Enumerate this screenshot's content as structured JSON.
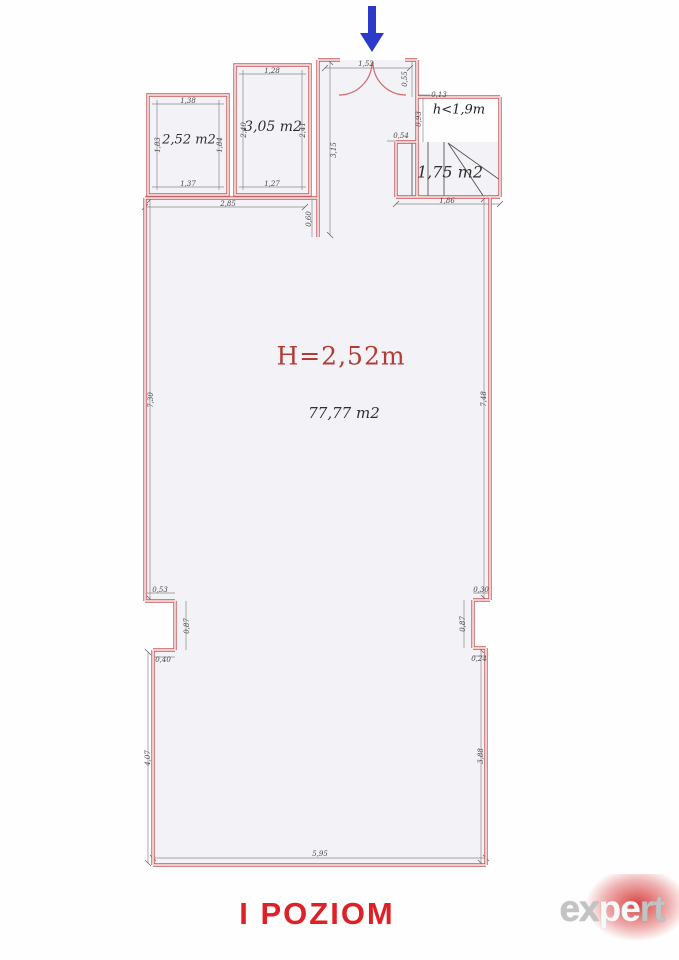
{
  "title": "I POZIOM",
  "plan": {
    "entrance": {
      "dim_door": "1,52",
      "dim_right": "0,55",
      "dim_corridor": "3,15",
      "dim_stub": "0,60"
    },
    "low_headroom": {
      "label": "h<1,9m",
      "dim_top": "0,13",
      "dim_left": "0,93",
      "dim_offset": "0,54"
    },
    "stairs": {
      "area": "1,75 m2",
      "dim_bottom": "1,86"
    },
    "room_252": {
      "area": "2,52 m2",
      "dim_top": "1,38",
      "dim_bottom": "1,37",
      "dim_left": "1,83",
      "dim_right": "1,84"
    },
    "room_305": {
      "area": "3,05 m2",
      "dim_top": "1,28",
      "dim_bottom": "1,27",
      "dim_left": "2,40",
      "dim_right": "2,41"
    },
    "main_room": {
      "height_label": "H=2,52m",
      "area": "77,77 m2",
      "dim_top": "2,85",
      "dim_left": "7,30",
      "dim_right": "7,48",
      "notch_left": {
        "top": "0,53",
        "side": "0,87",
        "bottom": "0,40"
      },
      "notch_right": {
        "top": "0,30",
        "side": "0,87",
        "bottom": "0,24"
      },
      "dim_lower_left": "4,07",
      "dim_lower_right": "3,88",
      "dim_bottom": "5,95"
    }
  },
  "logo": {
    "text": "expert",
    "parts": {
      "left": "ex",
      "mid": "pe",
      "right": "rt"
    }
  },
  "colors": {
    "wall_red": "#c9585a",
    "floor_fill": "#f3f2f6",
    "dim_gray": "#8a8a8a",
    "label_red": "#b23c35",
    "title_red": "#dd2127",
    "arrow_blue": "#2b3ac8",
    "logo_red": "#d22323",
    "logo_gray": "#c3c3c3"
  }
}
